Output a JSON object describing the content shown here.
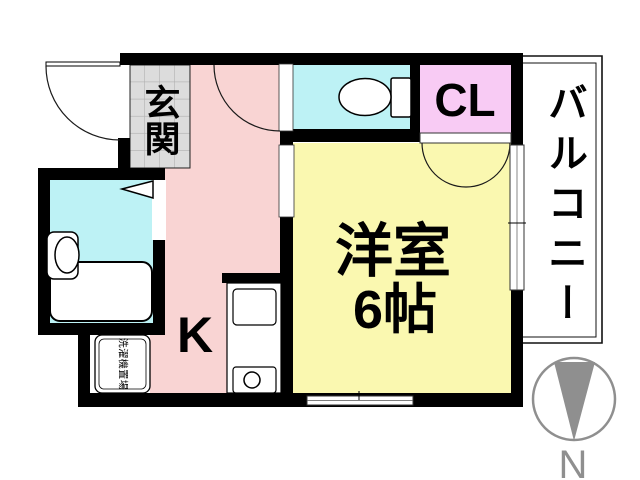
{
  "labels": {
    "entrance": "玄関",
    "kitchen": "K",
    "room_name": "洋室",
    "room_size": "6帖",
    "closet": "CL",
    "balcony": "バルコニー",
    "laundry": "洗濯機置場",
    "compass_north": "N"
  },
  "colors": {
    "wall": "#000000",
    "kitchen_pink": "#f9d4d3",
    "room_yellow": "#faf8b0",
    "water_cyan": "#bdf2f5",
    "closet_pink": "#f8cbf4",
    "tile_gray": "#dcdcdc",
    "tile_line": "#b0b0b0",
    "compass_gray": "#8f8f8f"
  }
}
